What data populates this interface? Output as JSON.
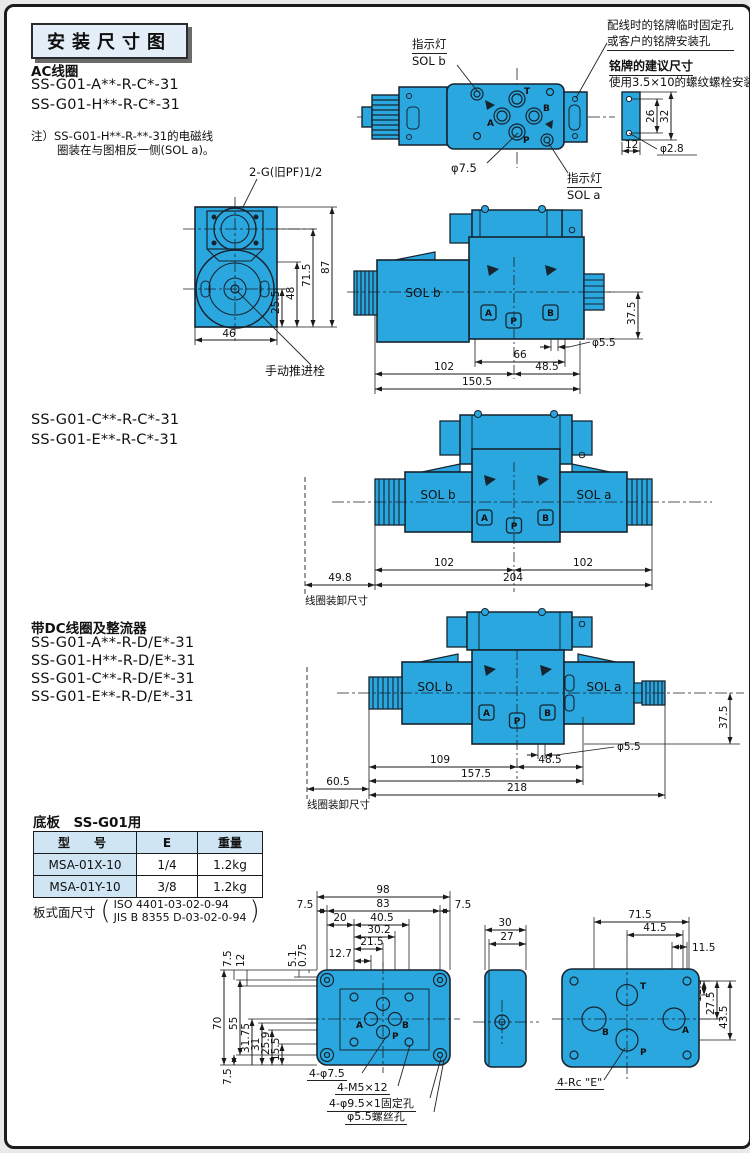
{
  "page": {
    "title": "安装尺寸图"
  },
  "sections": {
    "ac": {
      "heading": "AC线圈",
      "model1": "SS-G01-A**-R-C*-31",
      "model2": "SS-G01-H**-R-C*-31",
      "note1": "注）SS-G01-H**-R-**-31的电磁线",
      "note2": "圈装在与图相反一侧(SOL a)。"
    },
    "cde": {
      "model1": "SS-G01-C**-R-C*-31",
      "model2": "SS-G01-E**-R-C*-31"
    },
    "dc": {
      "heading": "带DC线圈及整流器",
      "model1": "SS-G01-A**-R-D/E*-31",
      "model2": "SS-G01-H**-R-D/E*-31",
      "model3": "SS-G01-C**-R-D/E*-31",
      "model4": "SS-G01-E**-R-D/E*-31"
    }
  },
  "topview": {
    "ind_label": "指示灯",
    "sol_b": "SOL b",
    "sol_a": "SOL a",
    "phi75": "φ7.5",
    "port_t": "T",
    "port_b": "B",
    "port_a": "A",
    "port_p": "P",
    "plate_note1": "配线时的铭牌临时固定孔",
    "plate_note2": "或客户的铭牌安装孔",
    "plate_title": "铭牌的建议尺寸",
    "plate_sub": "使用3.5×10的螺纹螺栓安装",
    "d26": "26",
    "d32": "32",
    "d12": "12",
    "d28": "φ2.8"
  },
  "endview": {
    "port_label": "2-G(旧PF)1/2",
    "d87": "87",
    "d715": "71.5",
    "d48": "48",
    "d255": "25.5",
    "d46": "46",
    "manual": "手动推进栓"
  },
  "side1": {
    "sol_b": "SOL b",
    "d375": "37.5",
    "phi55": "φ5.5",
    "d102": "102",
    "d66": "66",
    "d485": "48.5",
    "d1505": "150.5",
    "pa": "A",
    "pp": "P",
    "pb": "B"
  },
  "dbl": {
    "sol_b": "SOL b",
    "sol_a": "SOL a",
    "d102l": "102",
    "d102r": "102",
    "d204": "204",
    "d498": "49.8",
    "coil": "线圈装卸尺寸",
    "pa": "A",
    "pp": "P",
    "pb": "B"
  },
  "dcv": {
    "sol_b": "SOL b",
    "sol_a": "SOL a",
    "d109": "109",
    "d485": "48.5",
    "d1575": "157.5",
    "d218": "218",
    "phi55": "φ5.5",
    "d375": "37.5",
    "d605": "60.5",
    "coil": "线圈装卸尺寸",
    "pa": "A",
    "pp": "P",
    "pb": "B"
  },
  "baseplate": {
    "heading": "底板　SS-G01用",
    "table": {
      "h_model": "型　号",
      "h_e": "E",
      "h_w": "重量",
      "rows": [
        {
          "model": "MSA-01X-10",
          "e": "1/4",
          "w": "1.2kg"
        },
        {
          "model": "MSA-01Y-10",
          "e": "3/8",
          "w": "1.2kg"
        }
      ]
    },
    "surface": "板式面尺寸",
    "iso": "ISO 4401-03-02-0-94",
    "jis": "JIS B 8355 D-03-02-0-94"
  },
  "ptop": {
    "d98": "98",
    "d75a": "7.5",
    "d83": "83",
    "d75b": "7.5",
    "d20": "20",
    "d405": "40.5",
    "d302": "30.2",
    "d215": "21.5",
    "d127": "12.7",
    "v75t": "7.5",
    "v12": "12",
    "v51": "5.1",
    "v075": "0.75",
    "v70": "70",
    "v55": "55",
    "v3175": "31.75",
    "v31": "31",
    "v259": "25.9",
    "v155": "15.5",
    "v75b": "7.5",
    "pa": "A",
    "pb": "B",
    "pp": "P",
    "l1": "4-φ7.5",
    "l2": "4-M5×12",
    "l3": "4-φ9.5×1固定孔",
    "l4": "φ5.5螺丝孔"
  },
  "pside": {
    "d30": "30",
    "d27": "27"
  },
  "pbot": {
    "d715": "71.5",
    "d415": "41.5",
    "d115a": "11.5",
    "d115b": "11.5",
    "d275": "27.5",
    "d435": "43.5",
    "pt": "T",
    "pb": "B",
    "pa": "A",
    "pp": "P",
    "rc": "4-Rc \"E\""
  }
}
